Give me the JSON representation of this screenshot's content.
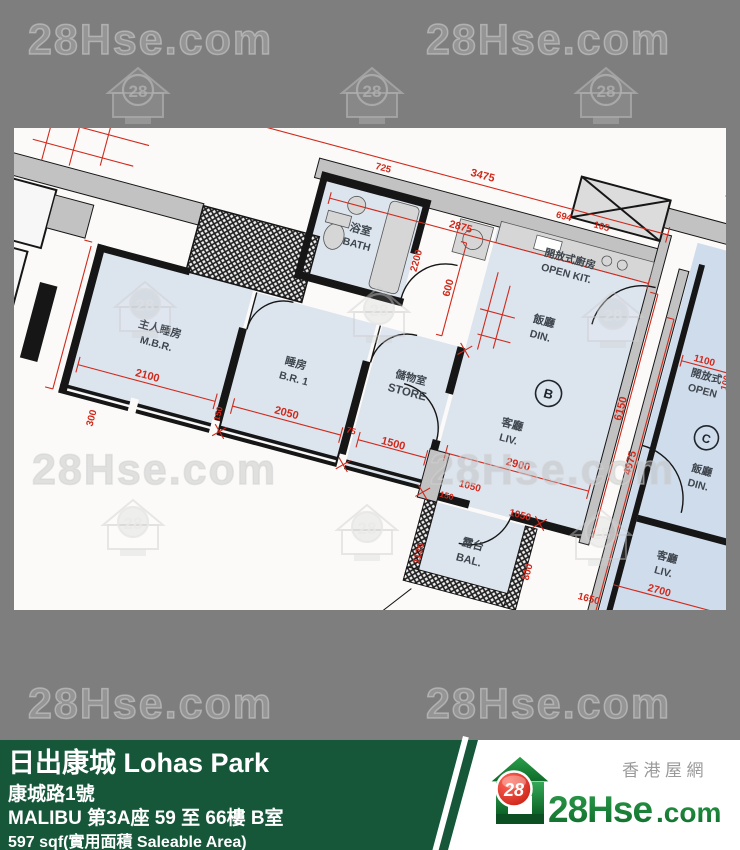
{
  "watermark": {
    "text": "28Hse.com",
    "badge": "28"
  },
  "plan": {
    "units": {
      "b": "B",
      "c": "C"
    },
    "rooms": {
      "mbr_zh": "主人睡房",
      "mbr_en": "M.B.R.",
      "br1_zh": "睡房",
      "br1_en": "B.R. 1",
      "store_zh": "儲物室",
      "store_en": "STORE",
      "bath_zh": "浴室",
      "bath_en": "BATH",
      "openkit_zh": "開放式廚房",
      "openkit_en": "OPEN KIT.",
      "din_zh": "飯廳",
      "din_en": "DIN.",
      "liv_zh": "客廳",
      "liv_en": "LIV.",
      "bal_zh": "露台",
      "bal_en": "BAL.",
      "c_openkit_zh": "開放式",
      "c_openkit_en": "OPEN",
      "c_din_zh": "飯廳",
      "c_din_en": "DIN.",
      "c_liv_zh": "客廳",
      "c_liv_en": "LIV."
    },
    "dims": {
      "d825": "825",
      "d3475": "3475",
      "d725": "725",
      "d694": "694",
      "d105": "105",
      "d2875": "2875",
      "d600": "600",
      "d2200": "2200",
      "d300": "300",
      "d2100": "2100",
      "d150a": "150",
      "d2050": "2050",
      "d75": "75",
      "d1500": "1500",
      "d2900": "2900",
      "d1050a": "1050",
      "d150b": "150",
      "d1050b": "1050",
      "d6150": "6150",
      "d4975": "4975",
      "d3875": "3875",
      "d1100": "1100",
      "d100": "100",
      "d1130": "1130",
      "d800": "800",
      "d1650": "1650",
      "d2700": "2700"
    }
  },
  "banner": {
    "title": "日出康城 Lohas Park",
    "address": "康城路1號",
    "unit": "MALIBU 第3A座 59 至 66樓 B室",
    "area": "597 sqf(實用面積 Saleable Area)"
  },
  "logo": {
    "tagline": "香港屋網",
    "badge": "28",
    "brand_main": "28Hse",
    "brand_suffix": ".com",
    "green": "#1e8f3c",
    "red": "#d61d12",
    "banner_green": "#16573a",
    "plan_red": "#d02a1c"
  }
}
